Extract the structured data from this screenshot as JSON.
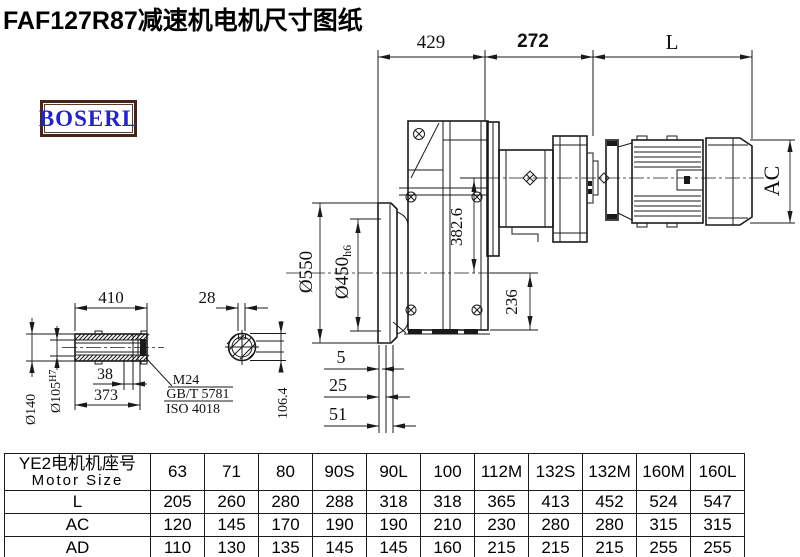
{
  "title": "FAF127R87减速机电机尺寸图纸",
  "logo": "BOSERL",
  "colors": {
    "line": "#1a1a1a",
    "logo_text": "#2424c0",
    "logo_border": "#46241c"
  },
  "dims": {
    "top1": "429",
    "top2": "272",
    "top3": "L",
    "ac": "AC",
    "axis": "382.6",
    "foot": "236",
    "flange": "Ø550",
    "spigot": "Ø450",
    "spigot_tol": "h6",
    "off1": "5",
    "off2": "25",
    "off3": "51",
    "shaft_len": "410",
    "key_w": "28",
    "shaft_od": "Ø140",
    "bore": "Ø105",
    "bore_tol": "H7",
    "d38": "38",
    "d373": "373",
    "across": "106.4",
    "bolt": "M24",
    "std1": "GB/T 5781",
    "std2": "ISO 4018"
  },
  "table": {
    "header_cn": "YE2电机机座号",
    "header_en": "Motor Size",
    "columns": [
      "63",
      "71",
      "80",
      "90S",
      "90L",
      "100",
      "112M",
      "132S",
      "132M",
      "160M",
      "160L"
    ],
    "rows": [
      {
        "label": "L",
        "values": [
          "205",
          "260",
          "280",
          "288",
          "318",
          "318",
          "365",
          "413",
          "452",
          "524",
          "547"
        ]
      },
      {
        "label": "AC",
        "values": [
          "120",
          "145",
          "170",
          "190",
          "190",
          "210",
          "230",
          "280",
          "280",
          "315",
          "315"
        ]
      },
      {
        "label": "AD",
        "values": [
          "110",
          "130",
          "135",
          "145",
          "145",
          "160",
          "215",
          "215",
          "215",
          "255",
          "255"
        ]
      }
    ]
  }
}
